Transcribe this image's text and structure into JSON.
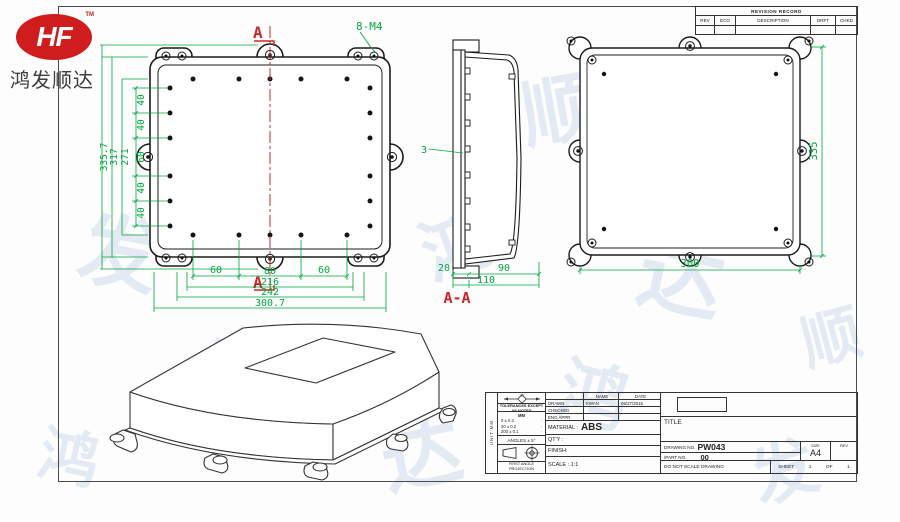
{
  "logo": {
    "mark": "HF",
    "tm": "TM",
    "company": "鸿发顺达"
  },
  "colors": {
    "dim_green": "#00a63e",
    "section_red": "#c62828",
    "line": "#1b1b1b"
  },
  "front_view": {
    "section_marker_top": "A",
    "section_marker_bottom": "A",
    "thread_note": "8-M4",
    "left_chain": [
      "40",
      "40",
      "60",
      "40",
      "40"
    ],
    "left_dims": [
      "271",
      "317",
      "335.7"
    ],
    "bottom_chain": [
      "60",
      "80",
      "60"
    ],
    "bottom_dims": [
      "216",
      "242",
      "300.7"
    ]
  },
  "section_view": {
    "wall_dim": "3",
    "chain": [
      "20",
      "90"
    ],
    "total": "110",
    "label": "A-A"
  },
  "back_view": {
    "height_dim": "335",
    "width_dim": "300"
  },
  "revision": {
    "title": "REVISION RECORD",
    "columns": [
      "REV",
      "ECO",
      "DESCRIPTION",
      "DRFT",
      "CHKD"
    ]
  },
  "title_block": {
    "side_note": "UNIT:MM",
    "sym_label": "XX",
    "tolerances_title": "TOLERANCES EXCEPT AS NOTED",
    "tol_header": "MM",
    "tol_rows": [
      "0 ± 0.3",
      "20 ± 0.2",
      "200 ± 0.1"
    ],
    "tol_dot": "·",
    "angles": "ANGLES ± 5°",
    "projection": "FIRST ANGLE PROJECTION",
    "name_header": "NAME",
    "date_header": "DATE",
    "drawn_label": "DRAWN",
    "drawn_name": "KWAN",
    "drawn_date": "05/27/2015",
    "checked_label": "CHECKED",
    "eng_label": "ENG APPR",
    "material_label": "MATERIAL :",
    "material_value": "ABS",
    "qty_label": "QT'Y :",
    "finish_label": "FINISH:",
    "scale_label": "SCALE : 1:1",
    "title_label": "TITLE",
    "drawing_no_label": "DRAWING NO.",
    "drawing_no": "PW043",
    "part_no_label": "/PART  NO.",
    "part_no": "00",
    "size_label": "SIZE",
    "size_value": "A4",
    "rev_label": "REV",
    "no_scale": "DO NOT SCALE DRAWING",
    "sheet_label": "SHEET",
    "sheet_num": "1",
    "of_label": "OF",
    "sheet_total": "1"
  },
  "watermark": {
    "items": [
      {
        "ch": "鸿",
        "x": 150,
        "y": 40,
        "s": 70,
        "r": -15
      },
      {
        "ch": "达",
        "x": 300,
        "y": 70,
        "s": 60,
        "r": 20
      },
      {
        "ch": "顺",
        "x": 520,
        "y": 50,
        "s": 75,
        "r": -10
      },
      {
        "ch": "发",
        "x": 700,
        "y": 100,
        "s": 65,
        "r": 15
      },
      {
        "ch": "发",
        "x": 80,
        "y": 190,
        "s": 80,
        "r": 10
      },
      {
        "ch": "鸿",
        "x": 420,
        "y": 190,
        "s": 70,
        "r": -20
      },
      {
        "ch": "达",
        "x": 640,
        "y": 210,
        "s": 85,
        "r": 12
      },
      {
        "ch": "顺",
        "x": 800,
        "y": 290,
        "s": 60,
        "r": -15
      },
      {
        "ch": "顺",
        "x": 200,
        "y": 320,
        "s": 75,
        "r": 18
      },
      {
        "ch": "达",
        "x": 380,
        "y": 390,
        "s": 80,
        "r": -12
      },
      {
        "ch": "鸿",
        "x": 560,
        "y": 340,
        "s": 70,
        "r": 15
      },
      {
        "ch": "发",
        "x": 750,
        "y": 420,
        "s": 65,
        "r": -18
      },
      {
        "ch": "鸿",
        "x": 40,
        "y": 410,
        "s": 60,
        "r": 12
      }
    ]
  }
}
